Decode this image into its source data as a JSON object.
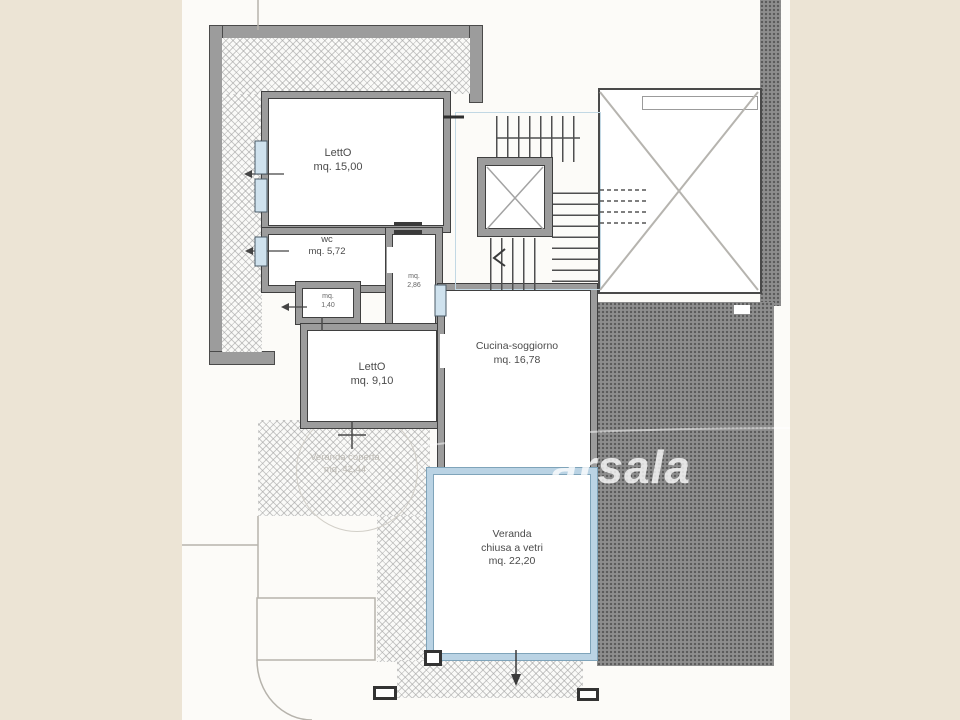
{
  "rooms": {
    "letto1": {
      "name": "LettO",
      "area": "mq. 15,00"
    },
    "wc": {
      "name": "wc",
      "area": "mq. 5,72"
    },
    "rip1": {
      "name": "mq.",
      "area": "1,40"
    },
    "rip2": {
      "name": "mq.",
      "area": "2,86"
    },
    "letto2": {
      "name": "LettO",
      "area": "mq. 9,10"
    },
    "cucina": {
      "name": "Cucina-soggiorno",
      "area": "mq. 16,78"
    },
    "veranda_vetri": {
      "line1": "Veranda",
      "line2": "chiusa a vetri",
      "area": "mq. 22,20"
    },
    "veranda_coperta": {
      "name": "Veranda coperta",
      "area": "mq. 42,44"
    }
  },
  "watermark": {
    "text": "arsala"
  },
  "colors": {
    "background": "#ece4d5",
    "paper": "#fcfbf8",
    "wall_fill": "#9c9c9c",
    "wall_line": "#3f3f3f",
    "glass_wall": "#bad3e4",
    "courtyard_gray": "#8e8e8e",
    "watermark_white": "#ffffff"
  }
}
